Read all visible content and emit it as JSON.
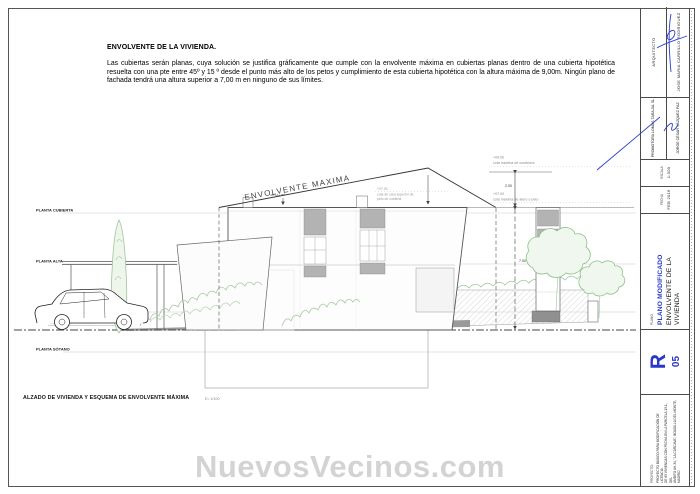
{
  "sheet": {
    "heading": "ENVOLVENTE DE LA VIVIENDA.",
    "paragraph": "Las cubiertas serán planas, cuya solución se justifica gráficamente que cumple con la envolvente máxima en cubiertas planas dentro de una cubierta hipotética resuelta con una pte entre 45º y 15 º desde el punto más alto de los petos y cumplimiento de esta cubierta hipotética con la altura máxima de 9,00m. Ningún plano de fachada tendrá una altura superior a 7,00 m en ninguno de sus límites.",
    "caption": "ALZADO DE VIVIENDA Y ESQUEMA DE ENVOLVENTE MÁXIMA",
    "caption_scale": "E= 1/100"
  },
  "drawing": {
    "envelope_label": "ENVOLVENTE MAXIMA",
    "angle_note": "45º+A+15º",
    "street_label": "RASANTE TEÓRICA DE CALLE",
    "levels": [
      {
        "label": "PLANTA CUBIERTA"
      },
      {
        "label": "PLANTA ALTA"
      },
      {
        "label": "PLANTA BAJA"
      },
      {
        "label": "PLANTA SÓTANO"
      }
    ],
    "ground": {
      "value": "±00.00",
      "desc": "cota de rasante de calle"
    },
    "ann": {
      "cumbrera_value": "+09.00",
      "cumbrera_desc": "cota máxima de cumbrera",
      "alero_value": "+07.00",
      "alero_desc": "cota máxima de alero o peto",
      "peto_value": "+07.00",
      "peto_desc1": "cota de cara superior de",
      "peto_desc2": "peto de cubierta",
      "dim_upper": "2.00",
      "dim_lower": "7.00"
    }
  },
  "titleblock": {
    "architect_label": "ARQUITECTO",
    "architect_name": "JOSE MARIA CARRILLO RODRIGUEZ",
    "promoter_company": "PROMOTORA LOMAS TARAJAL SL",
    "promoter_name": "JORGE CÉSAR VÁZQUEZ PAZ",
    "scale_label": "ESCALA",
    "scale_value": "1:300",
    "date_label": "FECHA",
    "date_value": "FEB 2016",
    "plano_label": "PLANO",
    "plano_status": "PLANO MODIFICADO",
    "plano_title": "ENVOLVENTE DE LA VIVIENDA",
    "revision_letter": "R",
    "sheet_number": "05",
    "project_label": "PROYECTO:",
    "project_lines": [
      "PROYECTO BÁSICO PARA MODIFICACIÓN DE LICENCIA",
      "DE 63 VIVIENDAS CON FECHA EN LA PARCELA 13.1, DEL",
      "ÁMBITO AH-34, \"LA CÁRCAVA\", BOADILLA DEL MONTE,",
      "MADRID"
    ]
  },
  "watermark": {
    "text": "NuevosVecinos.com"
  },
  "colors": {
    "accent_blue": "#2838c8",
    "vegetation_green": "#9cc69a",
    "window_gray": "#b3b3b3",
    "watermark_gray": "#d3d3d3",
    "line_dark": "#444444"
  }
}
